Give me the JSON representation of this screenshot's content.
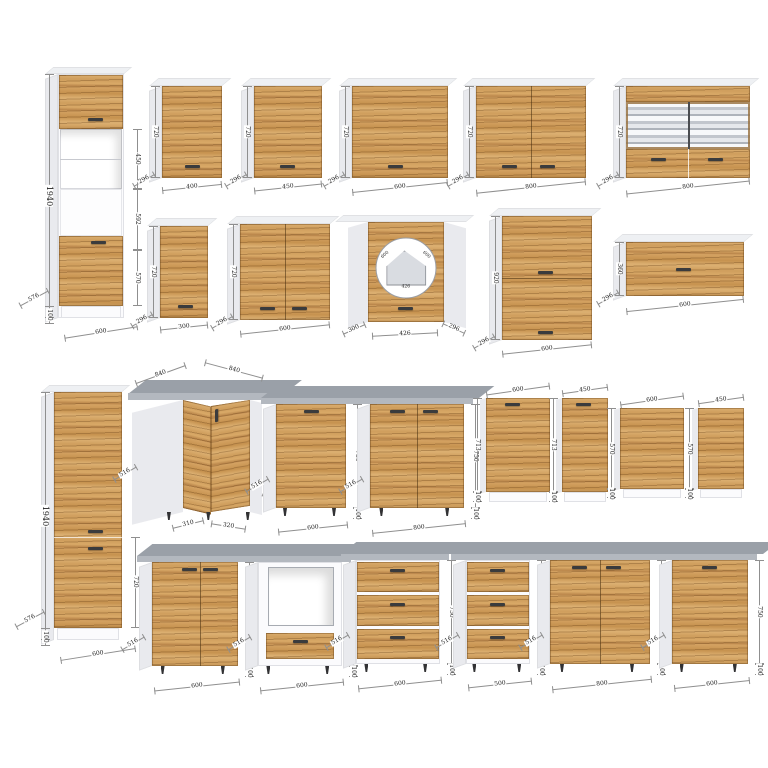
{
  "title": "kitchen-cabinet-dimension-catalog",
  "colors": {
    "background": "#ffffff",
    "wood": "#cf9e5d",
    "wood_dark": "#8a5a2e",
    "wood_light": "#dcb072",
    "carcass": "#fbfbfd",
    "side": "#e9eaee",
    "top": "#eef0f3",
    "counter": "#9aa0a8",
    "counter_edge": "#b3b8bf",
    "handle": "#3a3b3d",
    "glass_shelf": "#c2c6cd",
    "dim_line": "#8f8f8f",
    "dim_text": "#1c1c1c"
  },
  "cabinets": [
    {
      "id": "tall-oven-600",
      "kind": "talloven",
      "x": 58,
      "y": 74,
      "w": 66,
      "h": 244,
      "labels": {
        "height": "1940",
        "sec1": "450",
        "sec2": "592",
        "sec3": "570",
        "plinth": "100",
        "depth": "576",
        "width": "600"
      }
    },
    {
      "id": "wall-400",
      "kind": "wall",
      "doors": 1,
      "x": 162,
      "y": 86,
      "w": 60,
      "h": 92,
      "labels": {
        "width": "400",
        "depth": "296",
        "height": "720"
      }
    },
    {
      "id": "wall-450",
      "kind": "wall",
      "doors": 1,
      "x": 254,
      "y": 86,
      "w": 68,
      "h": 92,
      "labels": {
        "width": "450",
        "depth": "296",
        "height": "720"
      }
    },
    {
      "id": "wall-600",
      "kind": "wall",
      "doors": 1,
      "x": 352,
      "y": 86,
      "w": 96,
      "h": 92,
      "labels": {
        "width": "600",
        "depth": "296",
        "height": "720"
      }
    },
    {
      "id": "wall-800-2d",
      "kind": "wall",
      "doors": 2,
      "x": 476,
      "y": 86,
      "w": 110,
      "h": 92,
      "labels": {
        "width": "800",
        "depth": "296",
        "height": "720"
      }
    },
    {
      "id": "wall-800-glass",
      "kind": "glass",
      "x": 626,
      "y": 86,
      "w": 124,
      "h": 92,
      "labels": {
        "width": "800",
        "depth": "296",
        "height": "720"
      }
    },
    {
      "id": "wall-300",
      "kind": "wall",
      "doors": 1,
      "x": 160,
      "y": 226,
      "w": 48,
      "h": 92,
      "labels": {
        "width": "300",
        "depth": "296",
        "height": "720"
      }
    },
    {
      "id": "wall-600-2d",
      "kind": "wall",
      "doors": 2,
      "x": 240,
      "y": 224,
      "w": 90,
      "h": 96,
      "labels": {
        "width": "600",
        "depth": "296",
        "height": "720"
      }
    },
    {
      "id": "wall-corner-600",
      "kind": "cornerwall",
      "x": 348,
      "y": 222,
      "w": 118,
      "h": 100,
      "labels": {
        "left": "300",
        "front": "426",
        "right": "296",
        "plan_a": "600",
        "plan_b": "600",
        "plan_front": "426"
      }
    },
    {
      "id": "wall-600-tall",
      "kind": "walltall",
      "x": 502,
      "y": 216,
      "w": 90,
      "h": 124,
      "labels": {
        "width": "600",
        "depth": "296",
        "height": "920"
      }
    },
    {
      "id": "wall-600-flap",
      "kind": "flap",
      "x": 626,
      "y": 242,
      "w": 118,
      "h": 54,
      "labels": {
        "width": "600",
        "depth": "296",
        "height": "360"
      }
    },
    {
      "id": "tall-pantry-600",
      "kind": "pantry",
      "x": 54,
      "y": 392,
      "w": 68,
      "h": 248,
      "labels": {
        "height": "1940",
        "door": "720",
        "plinth": "100",
        "depth": "576",
        "width": "600"
      }
    },
    {
      "id": "base-corner-840",
      "kind": "cornerbase",
      "x": 146,
      "y": 400,
      "w": 116,
      "h": 112,
      "labels": {
        "top_a": "840",
        "top_b": "840",
        "depth_l": "516",
        "front_a": "310",
        "front_b": "320",
        "depth_r": "516"
      }
    },
    {
      "id": "base-600",
      "kind": "base",
      "doors": 1,
      "x": 276,
      "y": 404,
      "w": 70,
      "h": 104,
      "labels": {
        "width": "600",
        "depth": "516",
        "height": "750",
        "plinth": "100"
      }
    },
    {
      "id": "base-800",
      "kind": "base",
      "doors": 2,
      "x": 370,
      "y": 404,
      "w": 94,
      "h": 104,
      "labels": {
        "width": "800",
        "depth": "516",
        "height": "750",
        "plinth": "100"
      }
    },
    {
      "id": "dw-panel-600-713",
      "kind": "panel",
      "handle": true,
      "x": 486,
      "y": 398,
      "w": 64,
      "h": 104,
      "labels": {
        "width": "600",
        "height": "713",
        "plinth": "100"
      }
    },
    {
      "id": "dw-panel-450-713",
      "kind": "panel",
      "handle": true,
      "x": 562,
      "y": 398,
      "w": 46,
      "h": 104,
      "labels": {
        "width": "450",
        "height": "713",
        "plinth": "100"
      }
    },
    {
      "id": "dw-panel-600-570",
      "kind": "panel",
      "handle": false,
      "x": 620,
      "y": 408,
      "w": 64,
      "h": 90,
      "labels": {
        "width": "600",
        "height": "570",
        "plinth": "100"
      }
    },
    {
      "id": "dw-panel-450-570",
      "kind": "panel",
      "handle": false,
      "x": 698,
      "y": 408,
      "w": 46,
      "h": 90,
      "labels": {
        "width": "450",
        "height": "570",
        "plinth": "100"
      }
    },
    {
      "id": "base-600-combi",
      "kind": "combi",
      "x": 152,
      "y": 562,
      "w": 86,
      "h": 104,
      "labels": {
        "width": "600",
        "depth": "516",
        "height": "750",
        "plinth": "100"
      }
    },
    {
      "id": "base-600-oven",
      "kind": "ovenbase",
      "x": 258,
      "y": 562,
      "w": 84,
      "h": 104,
      "labels": {
        "width": "600",
        "depth": "516",
        "height": "750",
        "plinth": "100"
      }
    },
    {
      "id": "base-600-drawers",
      "kind": "drawers",
      "x": 356,
      "y": 560,
      "w": 84,
      "h": 104,
      "labels": {
        "width": "600",
        "depth": "516",
        "height": "750",
        "plinth": "100"
      }
    },
    {
      "id": "base-500-drawers",
      "kind": "drawers",
      "x": 466,
      "y": 560,
      "w": 64,
      "h": 104,
      "labels": {
        "width": "500",
        "depth": "516",
        "height": "750",
        "plinth": "100"
      }
    },
    {
      "id": "base-800-2d",
      "kind": "base",
      "doors": 2,
      "x": 550,
      "y": 560,
      "w": 100,
      "h": 104,
      "labels": {
        "width": "800",
        "depth": "516",
        "height": "750",
        "plinth": "100"
      }
    },
    {
      "id": "base-600-1d",
      "kind": "base",
      "doors": 1,
      "x": 672,
      "y": 560,
      "w": 76,
      "h": 104,
      "labels": {
        "width": "600",
        "depth": "516",
        "height": "750",
        "plinth": "100"
      }
    }
  ]
}
